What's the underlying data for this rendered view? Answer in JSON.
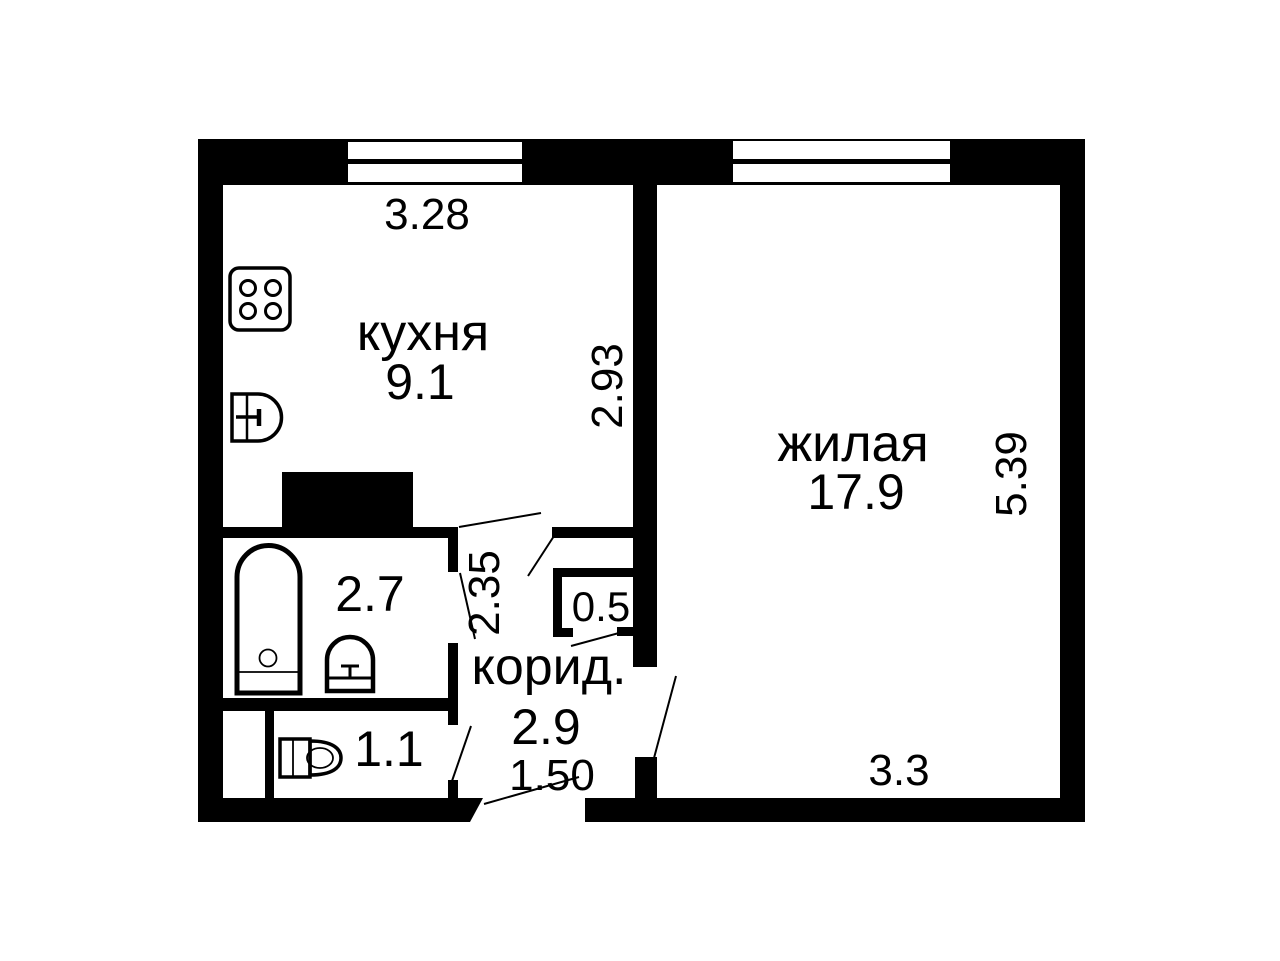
{
  "plan_title": "apartment-floor-plan",
  "colors": {
    "wall": "#000000",
    "background": "#ffffff",
    "text": "#000000"
  },
  "rooms": {
    "kitchen": {
      "label": "кухня",
      "area": "9.1"
    },
    "living": {
      "label": "жилая",
      "area": "17.9"
    },
    "corridor": {
      "label": "корид.",
      "area": "2.9"
    },
    "bathroom": {
      "area": "2.7"
    },
    "toilet": {
      "area": "1.1"
    },
    "closet": {
      "area": "0.5"
    }
  },
  "dimensions": {
    "kitchen_width_m": "3.28",
    "kitchen_depth_m": "2.93",
    "living_depth_m": "5.39",
    "living_width_m": "3.3",
    "corridor_depth_m": "2.35",
    "entrance_width_m": "1.50"
  }
}
